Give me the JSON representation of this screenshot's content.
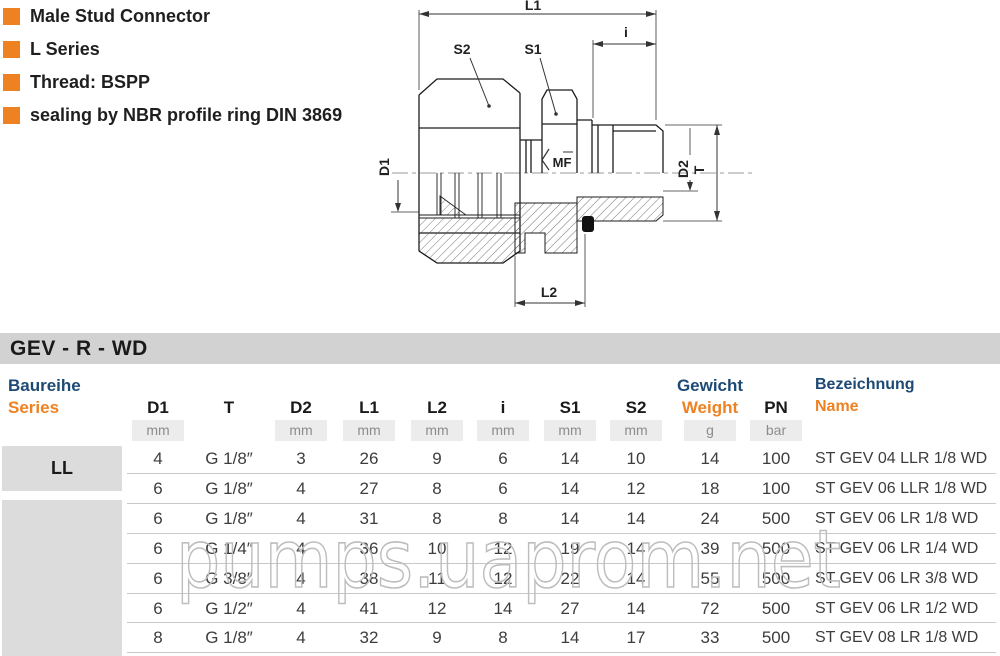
{
  "features": {
    "items": [
      {
        "label": "Male Stud Connector"
      },
      {
        "label": "L Series"
      },
      {
        "label": "Thread: BSPP"
      },
      {
        "label": "sealing by NBR profile ring DIN 3869"
      }
    ]
  },
  "drawing": {
    "labels": {
      "l1": "L1",
      "i": "i",
      "s2": "S2",
      "s1": "S1",
      "d1": "D1",
      "d2": "D2",
      "t": "T",
      "l2": "L2",
      "mf": "MF"
    }
  },
  "section_header": {
    "title": "GEV - R - WD"
  },
  "table": {
    "series_header": {
      "de": "Baureihe",
      "en": "Series"
    },
    "columns": [
      {
        "label": "D1",
        "unit": "mm"
      },
      {
        "label": "T",
        "unit": ""
      },
      {
        "label": "D2",
        "unit": "mm"
      },
      {
        "label": "L1",
        "unit": "mm"
      },
      {
        "label": "L2",
        "unit": "mm"
      },
      {
        "label": "i",
        "unit": "mm"
      },
      {
        "label": "S1",
        "unit": "mm"
      },
      {
        "label": "S2",
        "unit": "mm"
      },
      {
        "label": "Gewicht",
        "label2": "Weight",
        "unit": "g"
      },
      {
        "label": "PN",
        "unit": "bar"
      },
      {
        "label": "Bezeichnung",
        "label2": "Name",
        "unit": ""
      }
    ],
    "groups": [
      {
        "series": "LL"
      },
      {
        "series": ""
      }
    ],
    "rows": [
      {
        "cells": [
          "4",
          "G 1/8″",
          "3",
          "26",
          "9",
          "6",
          "14",
          "10",
          "14",
          "100",
          "ST GEV 04 LLR 1/8 WD"
        ]
      },
      {
        "cells": [
          "6",
          "G 1/8″",
          "4",
          "27",
          "8",
          "6",
          "14",
          "12",
          "18",
          "100",
          "ST GEV 06 LLR 1/8 WD"
        ]
      },
      {
        "cells": [
          "6",
          "G 1/8″",
          "4",
          "31",
          "8",
          "8",
          "14",
          "14",
          "24",
          "500",
          "ST GEV 06 LR 1/8 WD"
        ]
      },
      {
        "cells": [
          "6",
          "G 1/4″",
          "4",
          "36",
          "10",
          "12",
          "19",
          "14",
          "39",
          "500",
          "ST GEV 06 LR 1/4 WD"
        ]
      },
      {
        "cells": [
          "6",
          "G 3/8″",
          "4",
          "38",
          "11",
          "12",
          "22",
          "14",
          "55",
          "500",
          "ST GEV 06 LR 3/8 WD"
        ]
      },
      {
        "cells": [
          "6",
          "G 1/2″",
          "4",
          "41",
          "12",
          "14",
          "27",
          "14",
          "72",
          "500",
          "ST GEV 06 LR 1/2 WD"
        ]
      },
      {
        "cells": [
          "8",
          "G 1/8″",
          "4",
          "32",
          "9",
          "8",
          "14",
          "17",
          "33",
          "500",
          "ST GEV 08 LR 1/8 WD"
        ]
      }
    ]
  },
  "watermark": {
    "text": "pumps.uaprom.net"
  },
  "colors": {
    "accent_orange": "#ee8222",
    "heading_navy": "#1d4a74",
    "bar_gray": "#d2d2d2",
    "series_box_gray": "#dcdcdc",
    "unit_box_gray": "#ececec",
    "watermark_gray": "#bdbdbd"
  }
}
